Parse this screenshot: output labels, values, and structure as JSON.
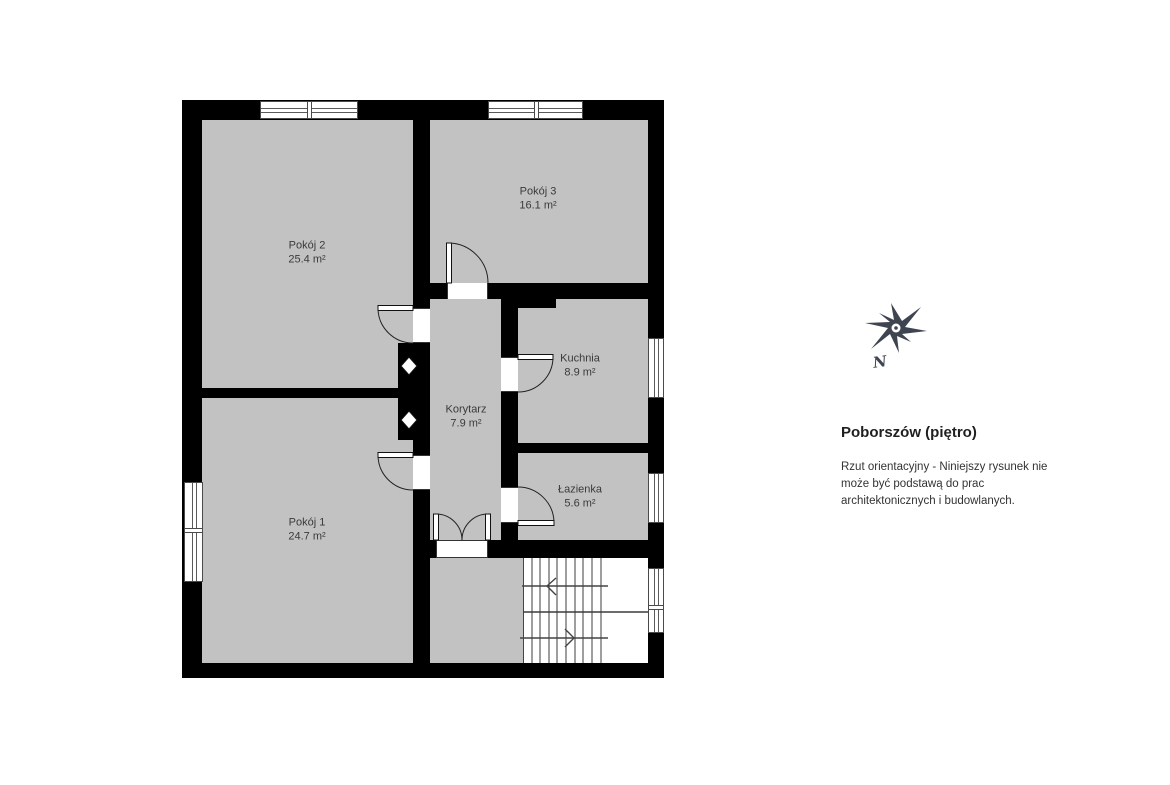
{
  "title": "Poborszów (piętro)",
  "disclaimer_lines": [
    "Rzut orientacyjny - Niniejszy rysunek nie",
    "może być podstawą do prac",
    "architektonicznych i budowlanych."
  ],
  "compass": {
    "label": "N"
  },
  "rooms": [
    {
      "name": "Pokój 2",
      "area": "25.4 m²"
    },
    {
      "name": "Pokój 3",
      "area": "16.1 m²"
    },
    {
      "name": "Kuchnia",
      "area": "8.9 m²"
    },
    {
      "name": "Korytarz",
      "area": "7.9 m²"
    },
    {
      "name": "Łazienka",
      "area": "5.6 m²"
    },
    {
      "name": "Pokój 1",
      "area": "24.7 m²"
    }
  ],
  "colors": {
    "wall": "#000000",
    "floor": "#c2c2c2",
    "background": "#ffffff",
    "compass": "#3e4551",
    "text": "#3a3a3a"
  }
}
